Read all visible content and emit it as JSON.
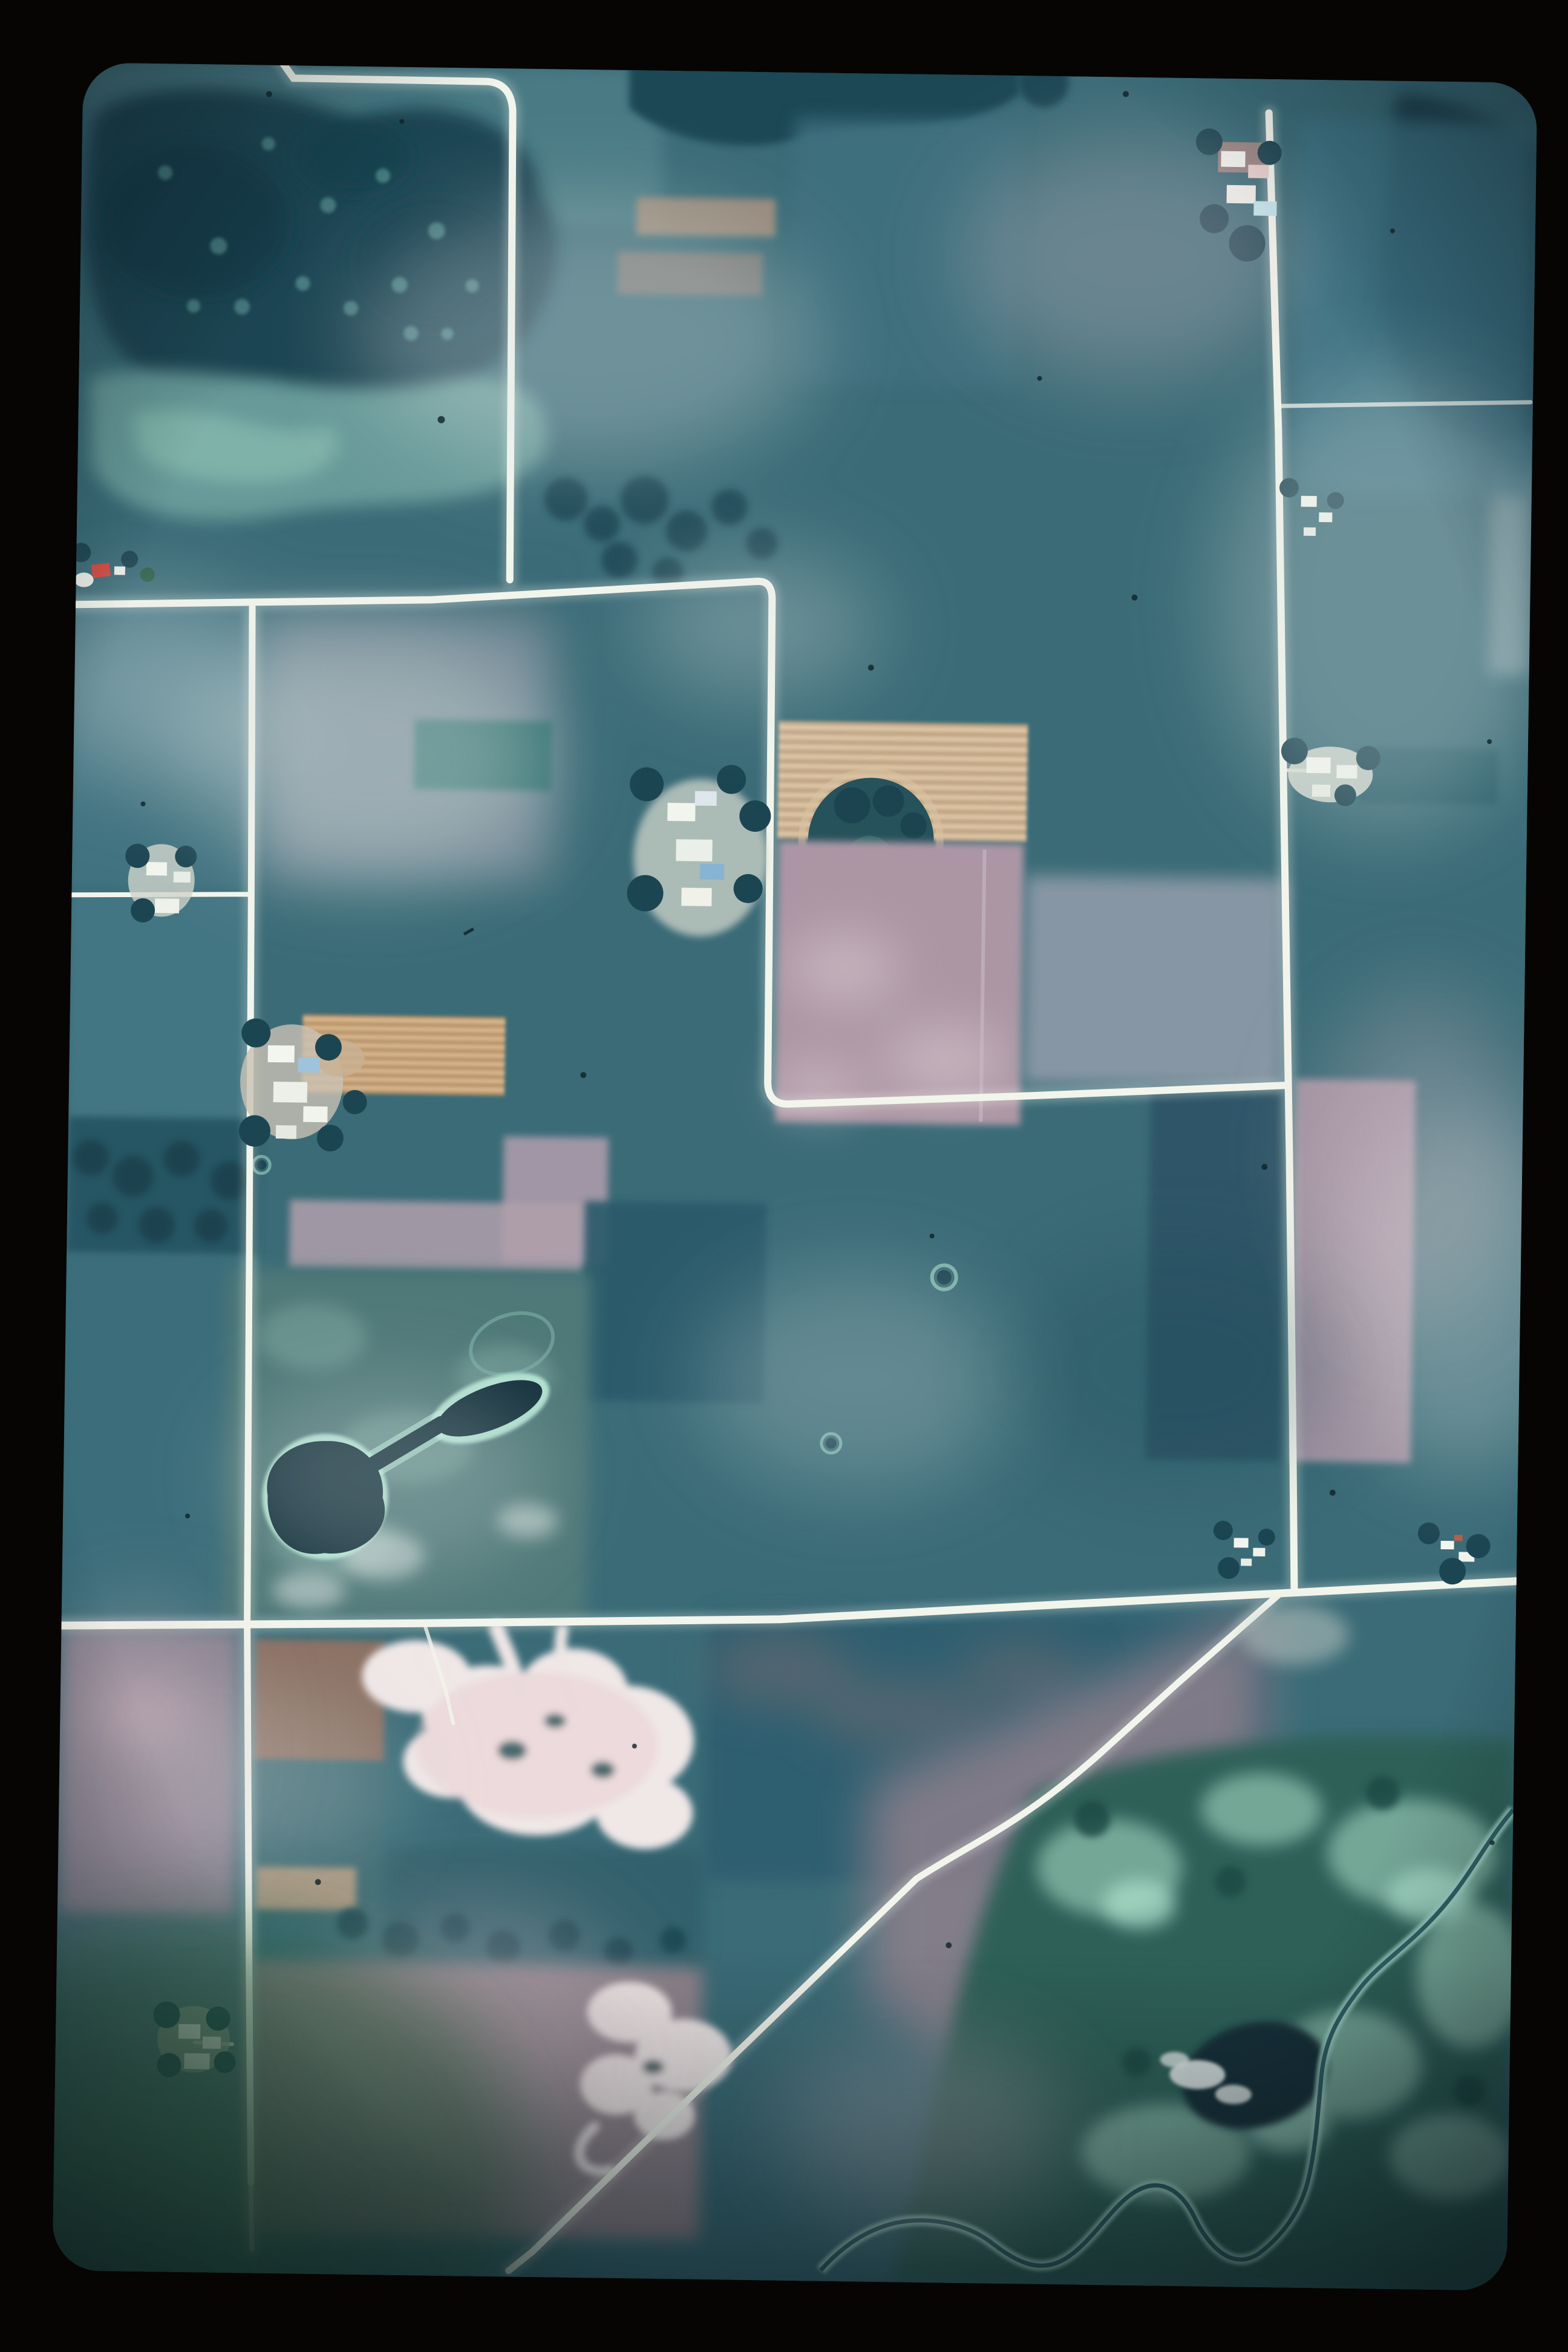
{
  "media": {
    "type": "35mm color slide scan",
    "subject": "Vertical aerial photograph of an agricultural township",
    "orientation": "portrait",
    "visible_text": "none"
  },
  "scene": {
    "description": "Low-altitude vertical air photo with strong cyan-teal film cast. A grid of bright white gravel section roads divides rectangular crop fields in teal, mauve-pink and tan. A dark lake and woodland complex with a light marsh band fills the northwest corner. Center holds a tan strip-cropped field with a round tree-ringed pond and a large pink fallow field. Mid-west is a dark dog-bone shaped pond with a bright aqua shoreline. South of the east-west road are two bright white sand/gravel pits, and the southeast corner is a bright green wetland with white-banked meandering creek and a dark pond. A diagonal road runs from the main intersection toward the southwest. Farmsteads with white buildings and tree windbreaks dot the road edges. Slide mount forms a black border; film frame has rounded corners, dust specks and a green haze in the bottom-left corner.",
    "land_cover": [
      "row-crop fields",
      "fallow pink fields",
      "pasture",
      "woodlots",
      "lake",
      "ponds",
      "marsh",
      "wetland",
      "sand and gravel pits",
      "meandering stream",
      "gravel section roads",
      "farmsteads"
    ]
  },
  "features": [
    {
      "name": "lake-woodland-complex",
      "location": "northwest corner"
    },
    {
      "name": "marsh-band",
      "location": "below northwest lake"
    },
    {
      "name": "north-east-west-road",
      "location": "upper left, joins north-south road"
    },
    {
      "name": "west-north-south-road",
      "location": "left third, top to bottom"
    },
    {
      "name": "central-north-south-road",
      "location": "center, curves east at mid-photo"
    },
    {
      "name": "east-north-south-road",
      "location": "right third, top to main intersection"
    },
    {
      "name": "south-east-west-road",
      "location": "full width at lower third"
    },
    {
      "name": "diagonal-road",
      "location": "from main intersection to bottom left"
    },
    {
      "name": "tan-strip-cropped-field-with-pond",
      "location": "center"
    },
    {
      "name": "orange-stubble-field",
      "location": "mid west"
    },
    {
      "name": "dog-bone-pond",
      "location": "mid west, bright aqua shoreline"
    },
    {
      "name": "sand-gravel-pit-north",
      "location": "south of east-west road, center-left"
    },
    {
      "name": "sand-gravel-pit-south",
      "location": "bottom center"
    },
    {
      "name": "wetland-with-creek",
      "location": "southeast corner"
    },
    {
      "name": "dark-wetland-pond",
      "location": "lower right"
    },
    {
      "name": "farmsteads",
      "count": 10,
      "location": "along section roads"
    },
    {
      "name": "red-roof-farm",
      "location": "left edge above east-west road"
    },
    {
      "name": "dust-specks",
      "location": "scattered on film"
    },
    {
      "name": "green-corner-haze",
      "location": "bottom-left of frame"
    }
  ],
  "palette": {
    "slide_mount": "#060503",
    "base_field_teal": "#3A6B77",
    "field_teal_light": "#4E7E88",
    "field_teal_dark": "#2F5F6F",
    "forest_dark": "#1C4553",
    "water_dark": "#14313C",
    "marsh_band": "#6FA39F",
    "wetland_base": "#2E6159",
    "marsh_bright": "#9CCDB9",
    "field_pink": "#AC96A4",
    "field_mauve_grey": "#909BA9",
    "field_pink_strip": "#A795A5",
    "field_brown": "#8A6F62",
    "field_tan": "#C9AE8C",
    "field_tan_line": "#E2CCAD",
    "field_orange_tan": "#C59F73",
    "quarry_white": "#F0E7E7",
    "road_white": "#F2F5EC",
    "river_bank": "#9ED4C6",
    "river_channel": "#27535B",
    "navy_field": "#2F5668",
    "pond_rim_aqua": "#BEEFDC",
    "red_roof": "#D2453C",
    "corner_green": "#2A5C3C"
  }
}
